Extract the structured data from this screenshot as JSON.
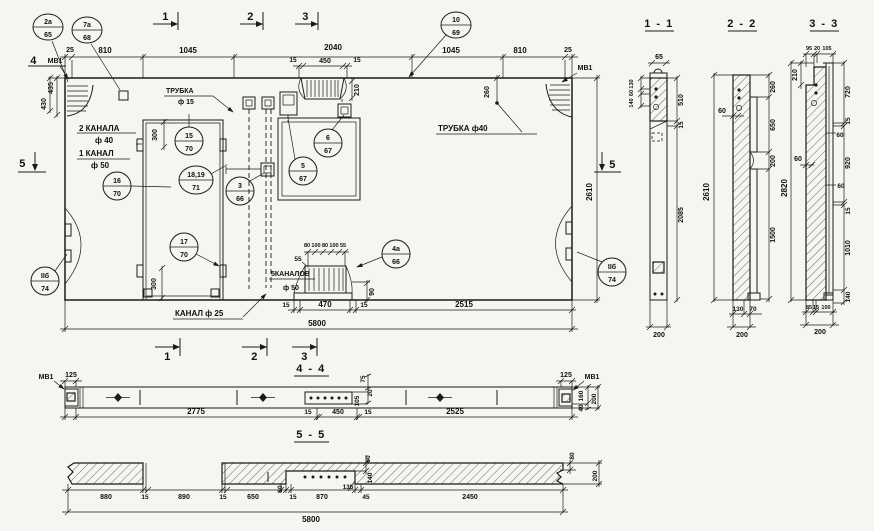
{
  "app": {
    "background": "#f6f5f1",
    "ink": "#1b1b1b"
  },
  "titles": {
    "s11": "1 - 1",
    "s22": "2 - 2",
    "s33": "3 - 3",
    "s44": "4 - 4",
    "s55": "5 - 5"
  },
  "marks": {
    "t1": "1",
    "t2": "2",
    "t3": "3",
    "b1": "1",
    "b2": "2",
    "b3": "3",
    "l4": "4",
    "l5": "5",
    "r5": "5",
    "mv1_plan_left": "МВ1",
    "mv1_plan_right": "МВ1",
    "mv1_44_left": "МВ1",
    "mv1_44_right": "МВ1"
  },
  "callouts": {
    "c2a": {
      "top": "2а",
      "bot": "65"
    },
    "c7a": {
      "top": "7а",
      "bot": "68"
    },
    "c10": {
      "top": "10",
      "bot": "69"
    },
    "c15": {
      "top": "15",
      "bot": "70"
    },
    "c1819": {
      "top": "18,19",
      "bot": "71"
    },
    "c16": {
      "top": "16",
      "bot": "70"
    },
    "c3": {
      "top": "3",
      "bot": "66"
    },
    "c17": {
      "top": "17",
      "bot": "70"
    },
    "c6": {
      "top": "6",
      "bot": "67"
    },
    "c5": {
      "top": "5",
      "bot": "67"
    },
    "c4a": {
      "top": "4а",
      "bot": "66"
    },
    "cIIl": {
      "top": "IIб",
      "bot": "74"
    },
    "cIIr": {
      "top": "IIб",
      "bot": "74"
    }
  },
  "labels": {
    "trubka15_1": "ТРУБКА",
    "trubka15_2": "ф 15",
    "kanala2": "2 КАНАЛА",
    "kanala2_d": "ф 40",
    "kanal1": "1 КАНАЛ",
    "kanal1_d": "ф 50",
    "trubka40": "ТРУБКА  ф40",
    "kanalov5": "5КАНАЛОВ",
    "kanalov5_d": "ф 50",
    "kanal25": "КАНАЛ ф 25"
  },
  "plan": {
    "top": {
      "d25l": "25",
      "d810l": "810",
      "d1045l": "1045",
      "d2040": "2040",
      "d1045r": "1045",
      "d810r": "810",
      "d25r": "25",
      "d450": "450",
      "d15l": "15",
      "d15r": "15",
      "d210": "210"
    },
    "left": {
      "d435": "435",
      "d430": "430"
    },
    "right": {
      "d260": "260",
      "d2610": "2610"
    },
    "mid": {
      "d300t": "300",
      "d300b": "300",
      "d80a": "80",
      "d100a": "100",
      "d80b": "80",
      "d100b": "100",
      "d55": "55",
      "d55l": "55",
      "d90": "90"
    },
    "bottom": {
      "d15l": "15",
      "d470": "470",
      "d15r": "15",
      "d2515": "2515",
      "d5800": "5800"
    }
  },
  "s11": {
    "d65": "65",
    "d130": "130",
    "d60": "60",
    "d140": "140",
    "d510": "510",
    "d15": "15",
    "d2085": "2085",
    "d200": "200"
  },
  "s22": {
    "d60": "60",
    "d2610": "2610",
    "d260": "260",
    "d650": "650",
    "d200": "200",
    "d1500": "1500",
    "b130": "130",
    "b70": "70",
    "b200": "200"
  },
  "s33": {
    "t95": "95",
    "t20": "20",
    "t105": "105",
    "d210": "210",
    "d60l": "60",
    "d2820": "2820",
    "d720": "720",
    "d15a": "15",
    "d60a": "60",
    "d920": "920",
    "d60b": "60",
    "d15b": "15",
    "d1010": "1010",
    "d140": "140",
    "b85": "85",
    "b15": "15",
    "b100": "100",
    "b200": "200"
  },
  "s44": {
    "d125l": "125",
    "d125r": "125",
    "d2775": "2775",
    "d15a": "15",
    "d450": "450",
    "d15b": "15",
    "d2525": "2525",
    "d75": "75",
    "d20": "20",
    "d105": "105",
    "d160": "160",
    "d40": "40",
    "d200": "200"
  },
  "s55": {
    "d880": "880",
    "d15a": "15",
    "d890": "890",
    "d15b": "15",
    "d650": "650",
    "d60a": "60",
    "d15c": "15",
    "d870": "870",
    "d135": "135",
    "d45": "45",
    "d2450": "2450",
    "d5800": "5800",
    "v60": "60",
    "v140": "140",
    "v80": "80",
    "v200": "200"
  }
}
